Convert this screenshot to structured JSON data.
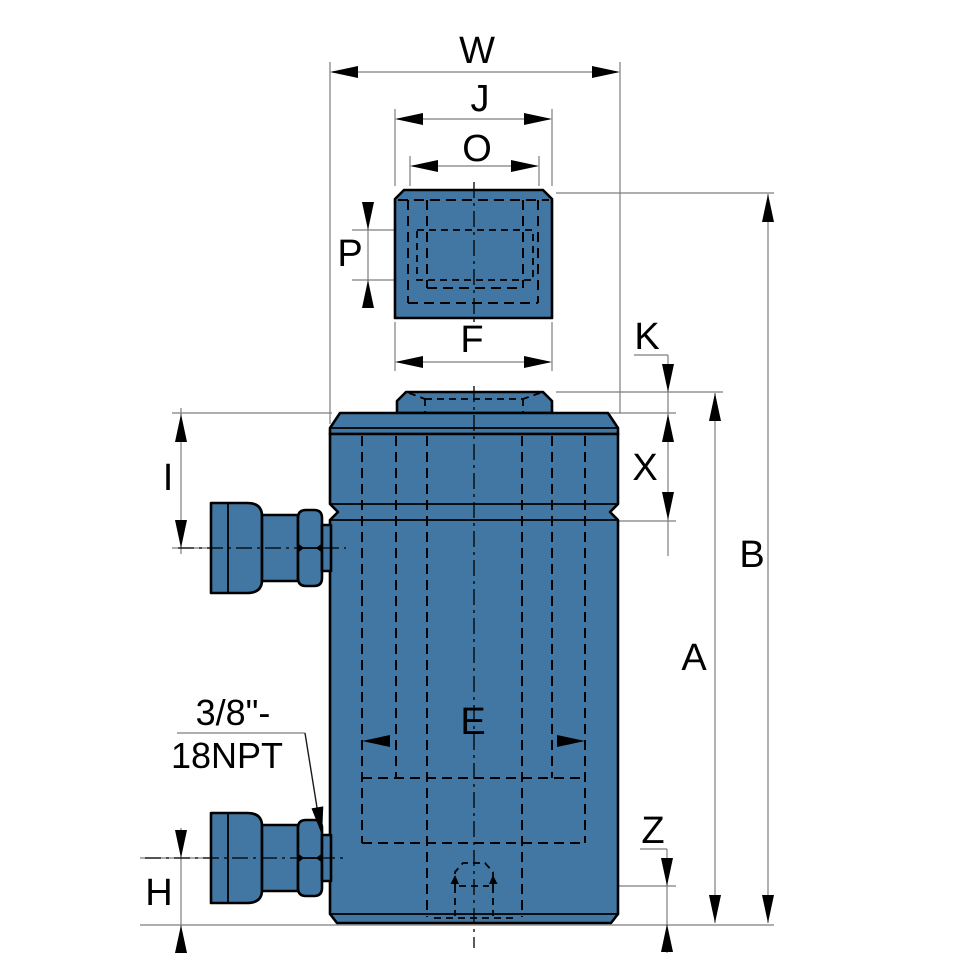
{
  "drawing": {
    "type": "hydraulic-cylinder-dimension-drawing",
    "labels": {
      "w": "W",
      "j": "J",
      "o": "O",
      "p": "P",
      "f": "F",
      "k": "K",
      "x": "X",
      "i": "I",
      "b": "B",
      "a": "A",
      "e": "E",
      "z": "Z",
      "h": "H"
    },
    "port_note": {
      "line1": "3/8\"-",
      "line2": "18NPT"
    },
    "colors": {
      "body_fill": "#4177A2",
      "outline": "#000000",
      "dim_line": "#7D7D7D",
      "label_text": "#000000",
      "background": "#FFFFFF"
    }
  }
}
